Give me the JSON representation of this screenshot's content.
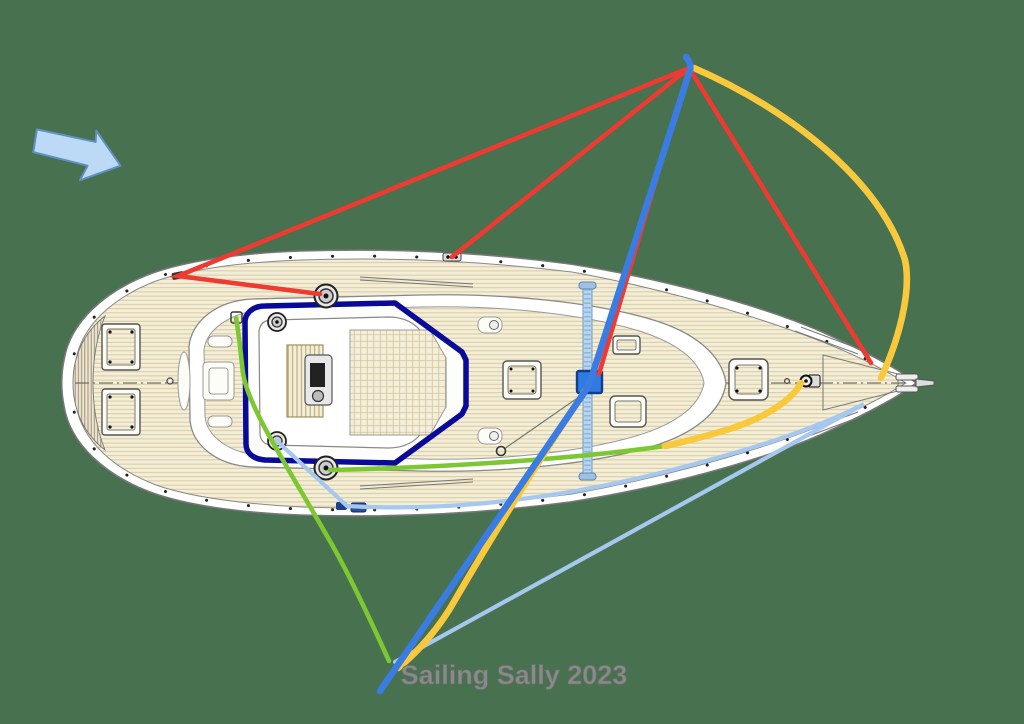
{
  "caption": {
    "text": "Sailing Sally 2023"
  },
  "colors": {
    "background": "#47714f",
    "caption_color": "#8a8a8a",
    "cockpit_coaming": "#0a0a99",
    "mast_block": "#2f7ce0",
    "mast_beam": "#b9d5ee",
    "line_red": "#ee3a30",
    "line_blue": "#3a7ce1",
    "line_yellow": "#f8c93c",
    "line_green": "#7dc832",
    "line_lightblue": "#a6c8ef",
    "arrow_fill": "#bcd9f5",
    "arrow_stroke": "#6090c0",
    "deck": "#f2eed9",
    "deck_grain": "#d8c795"
  },
  "wind_indicator": {
    "icon": "wind-direction-arrow",
    "direction": "pointing-right"
  },
  "legend_lines": [
    {
      "color_name": "red",
      "hex": "#ee3a30",
      "route": "masthead point fanned to port rail lead, stern winch, rail fitting, mast block and bow"
    },
    {
      "color_name": "royal-blue",
      "hex": "#3a7ce1",
      "route": "masthead point down through mast block to lower tack point"
    },
    {
      "color_name": "yellow",
      "hex": "#f8c93c",
      "route": "masthead point curving to bow; mast block to lower tack point; bow padeye aft along starboard deck"
    },
    {
      "color_name": "green",
      "hex": "#7dc832",
      "route": "port coachroof fitting to lower tack point; starboard deck lead to aft winch"
    },
    {
      "color_name": "light-blue",
      "hex": "#a6c8ef",
      "route": "cockpit winch to rail blocks, along starboard rail to bow, back to lower tack point"
    }
  ]
}
